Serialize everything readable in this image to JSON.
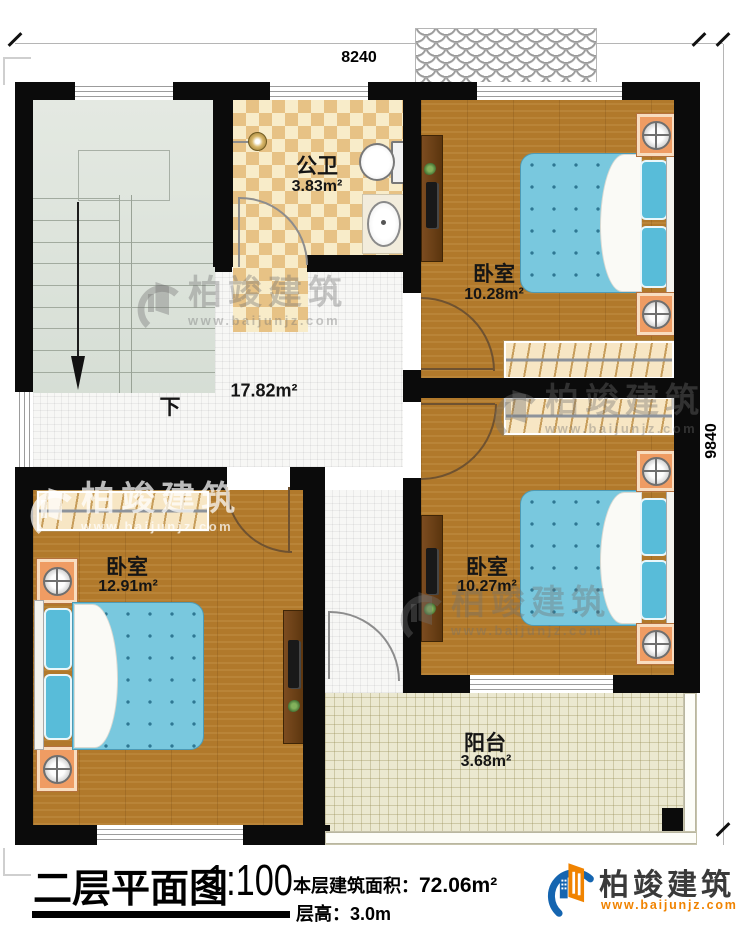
{
  "dimensions": {
    "top": "8240",
    "right": "9840"
  },
  "rooms": {
    "bathroom": {
      "name": "公卫",
      "area": "3.83m²"
    },
    "bedroom_top_right": {
      "name": "卧室",
      "area": "10.28m²"
    },
    "bedroom_mid_right": {
      "name": "卧室",
      "area": "10.27m²"
    },
    "bedroom_left": {
      "name": "卧室",
      "area": "12.91m²"
    },
    "hall": {
      "area": "17.82m²"
    },
    "balcony": {
      "name": "阳台",
      "area": "3.68m²"
    },
    "stairs": {
      "direction_label": "下"
    }
  },
  "title_block": {
    "title": "二层平面图",
    "scale": "1:100",
    "area_label": "本层建筑面积：",
    "area_value": "72.06m²",
    "floor_height_label": "层高：",
    "floor_height_value": "3.0m"
  },
  "branding": {
    "company": "柏竣建筑",
    "website": "www.baijunjz.com"
  },
  "colors": {
    "brand_blue": "#1565b0",
    "brand_orange": "#f08300",
    "wall": "#0b0b0b",
    "wood_floor": "#b1792b",
    "mattress_blue": "#79c8de",
    "stairs_floor": "#dde3da",
    "balcony_floor": "#ebe8d0",
    "nightstand_orange": "#ef9c63",
    "wardrobe_cream": "#f7e6c4"
  }
}
